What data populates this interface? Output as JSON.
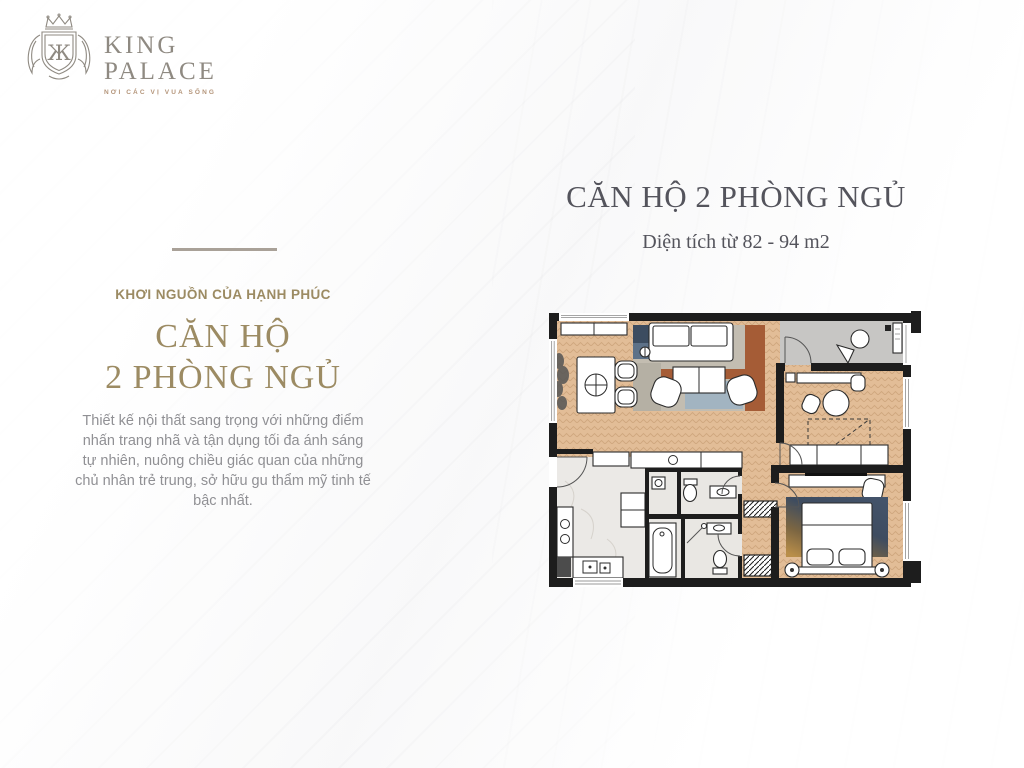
{
  "logo": {
    "line1": "KING",
    "line2": "PALACE",
    "tagline": "NƠI CÁC VỊ VUA SỐNG",
    "monogram": "Ж"
  },
  "left_panel": {
    "eyebrow": "KHƠI NGUỒN CỦA HẠNH PHÚC",
    "title_line1": "CĂN HỘ",
    "title_line2": "2 PHÒNG NGỦ",
    "body": "Thiết kế nội thất sang trọng với những điểm nhấn trang nhã và tận dụng tối đa ánh sáng tự nhiên, nuông chiều giác quan của những chủ nhân trẻ trung, sở hữu gu thẩm mỹ tinh tế bậc nhất."
  },
  "right_panel": {
    "title": "CĂN HỘ 2 PHÒNG NGỦ",
    "subtitle": "Diện tích từ 82 - 94 m2"
  },
  "floor_plan": {
    "description": "2-bedroom apartment floor plan drawing",
    "rooms": [
      "living-dining",
      "kitchen",
      "bathroom-1",
      "bathroom-2",
      "bedroom-1",
      "bedroom-2",
      "balcony",
      "hallway"
    ]
  },
  "colors": {
    "gold": "#9c8b63",
    "heading_dark": "#54545c",
    "body_text": "#909094",
    "divider": "#a9a198",
    "logo_gray": "#8f8a82",
    "logo_tagline": "#b4957a",
    "wall": "#1d1d1d",
    "wood": "#e2bd97",
    "wood_line": "#cfa77e",
    "marble": "#ebe9e6",
    "bath_floor": "#e9e7e3",
    "balcony": "#c7c6c4",
    "rug_blue": "#5d7188",
    "rug_navy": "#3c4c60",
    "rug_rust": "#a55c36",
    "rug_gray": "#c3bdb1",
    "rug_lightblue": "#a2b4c1",
    "bedrug_navy": "#3e4c60",
    "bedrug_gold": "#b98e49",
    "furniture_outline": "#2b2b2b"
  }
}
